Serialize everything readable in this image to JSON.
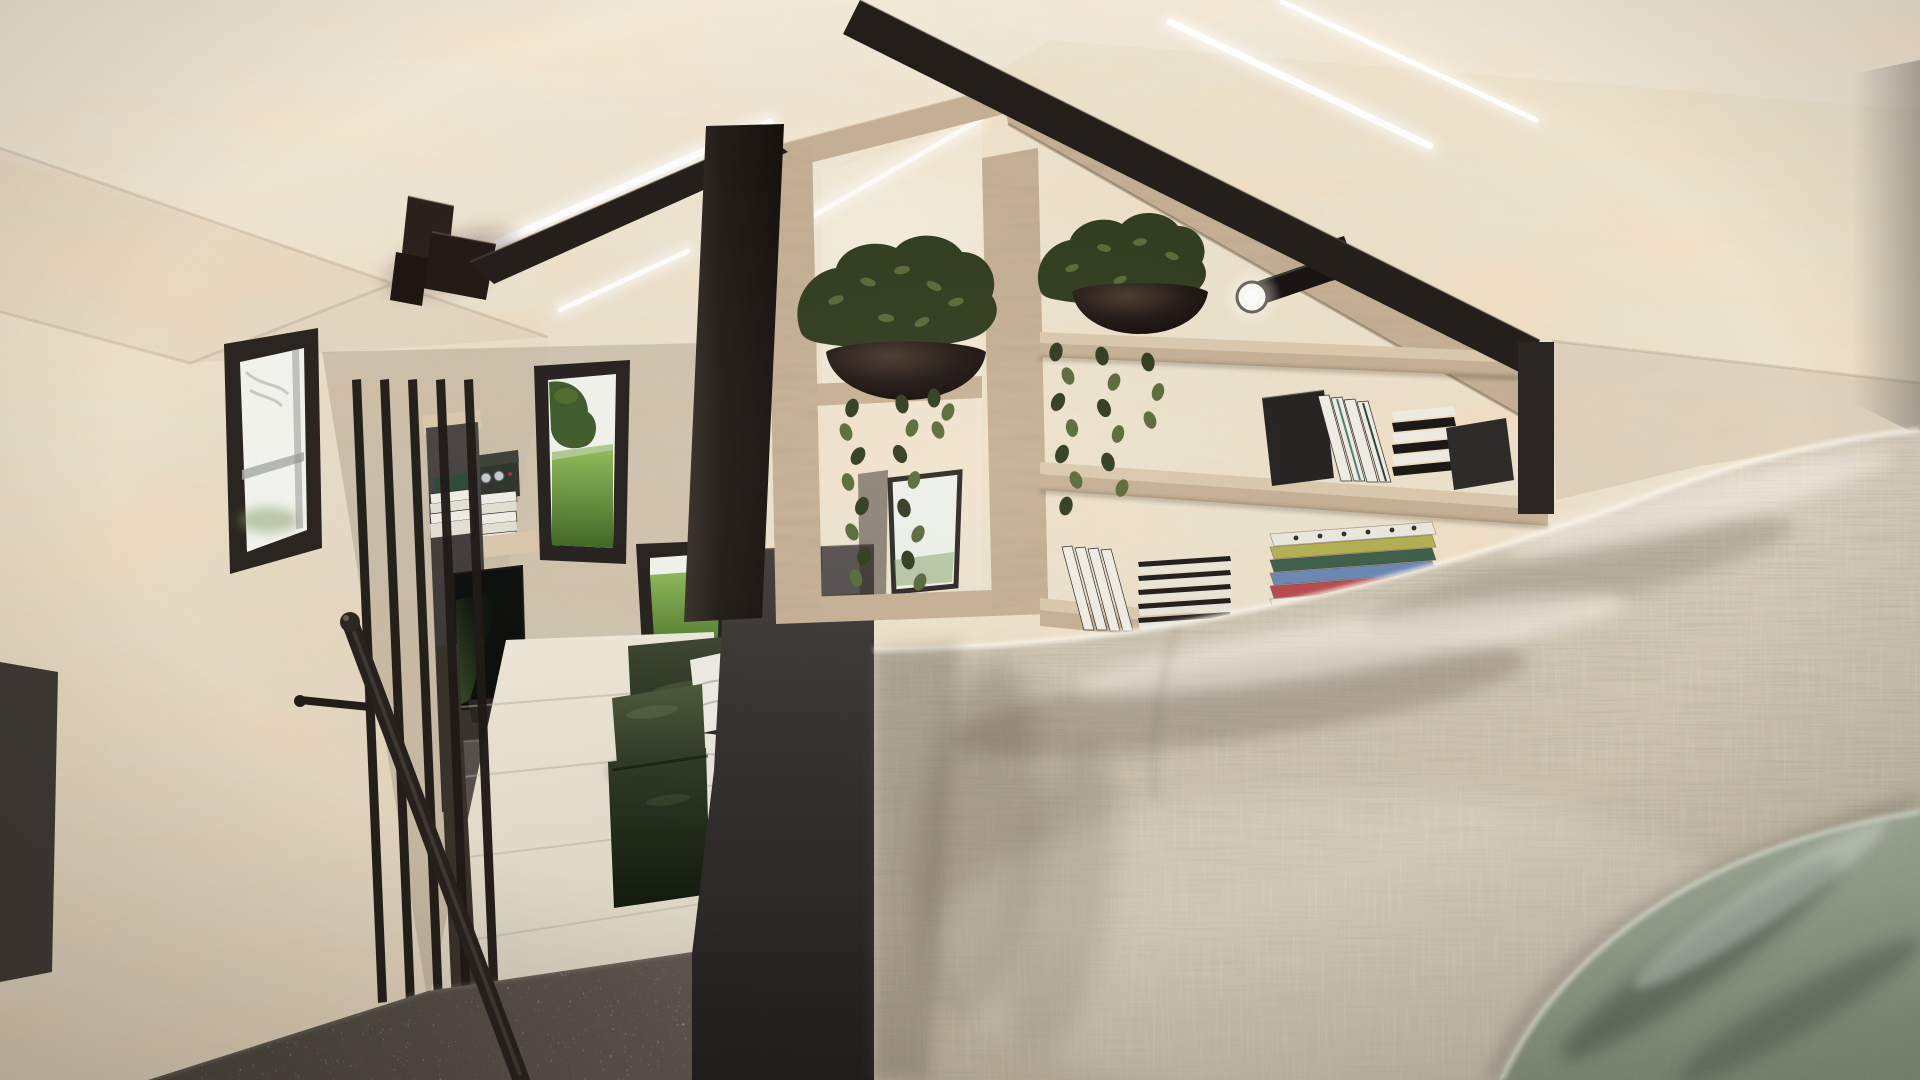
{
  "scene": {
    "title": "Tiny House Loft Bedroom - 3D Interior Render",
    "room": "sleeping loft",
    "style": "scandinavian plywood tiny-house interior",
    "description": "Daylit sleeping loft of a tiny house clad in pale pine plywood. A black steel A-frame and an oak gable shelving unit divide the loft from the stairwell. The shelves hold potted trailing plants in black bowls, rows of books and a black spotlight, while LED strips wash the roofline. A bed with a beige linen duvet and a sage green throw fills the right foreground, dark grey carpet covers the loft floor, and the lower level below shows a TV cabinet, black stair railing and handrail, windows onto a green meadow, and a dark green velvet bench with a white pillow and throw."
  },
  "palette": {
    "plywood": "#ece3ce",
    "oak": "#c7b195",
    "oakLight": "#dcc9ad",
    "oakDark": "#9c8468",
    "steel": "#241e1a",
    "steelLight": "#3d3531",
    "linen": "#cfc4b1",
    "sage": "#98a491",
    "carpet": "#524c44",
    "floorWood": "#e9e2d1",
    "meadow": "#7cae47",
    "meadowDark": "#47702b",
    "treeGreen": "#3f5c2c",
    "foliage": "#303c1e",
    "foliageLight": "#596b39",
    "potBlack": "#16100c",
    "cabinet": "#4c4744",
    "skyGlass": "#f3f4ee",
    "ledWhite": "#ffffff"
  },
  "lighting": {
    "led_strips": [
      "roofline strip left",
      "roofline strip inside gable",
      "roofline strips top right"
    ],
    "spotlight": "black track spotlight on gable shelf",
    "daylight": "bright overcast daylight through windows"
  },
  "windows": [
    {
      "id": "left-wall-window",
      "view": "bright white sky with faint branches"
    },
    {
      "id": "stairwell-upper-window",
      "view": "tree and green meadow"
    },
    {
      "id": "stairwell-lower-window",
      "view": "green meadow under pale sky"
    },
    {
      "id": "gable-cubby-glimpse",
      "view": "bright lower-level window behind vine"
    }
  ],
  "furniture": [
    "loft bed with beige linen duvet",
    "sage green throw blanket at foot of bed",
    "dark grey bed platform side panel",
    "dark grey loft carpet",
    "oak gable shelving unit",
    "black steel structural A-frame",
    "lower level TV cabinet with drawer",
    "wall shelf with books and radio",
    "dark green velvet bench with white pillow and fringed throw",
    "dark green velvet pouf",
    "black stair railing with round handrail",
    "ceiling-mounted dark speaker cluster"
  ],
  "plants": [
    "potted pothos in black bowl - left gable cubby",
    "potted pothos in black bowl - right shelf",
    "trailing vine - gable cubby",
    "trailing vine - right shelf"
  ],
  "books": {
    "upper_shelf_group": "charcoal slab, leaning white books, black and white stack",
    "lower_shelf_group": "leaning white books, dark covers with white page edges",
    "colored_stack": {
      "label": "stack of colourful books",
      "colors": [
        "#eceadf",
        "#b5b052",
        "#3f5f49",
        "#6e87b4",
        "#b84a4e",
        "#e8e2d2"
      ]
    },
    "tv_cabinet_stacks": "white book stacks with one green box"
  },
  "decor": [
    "chrome deer figurine",
    "small radio with chrome knobs",
    "dark slab book-end"
  ]
}
